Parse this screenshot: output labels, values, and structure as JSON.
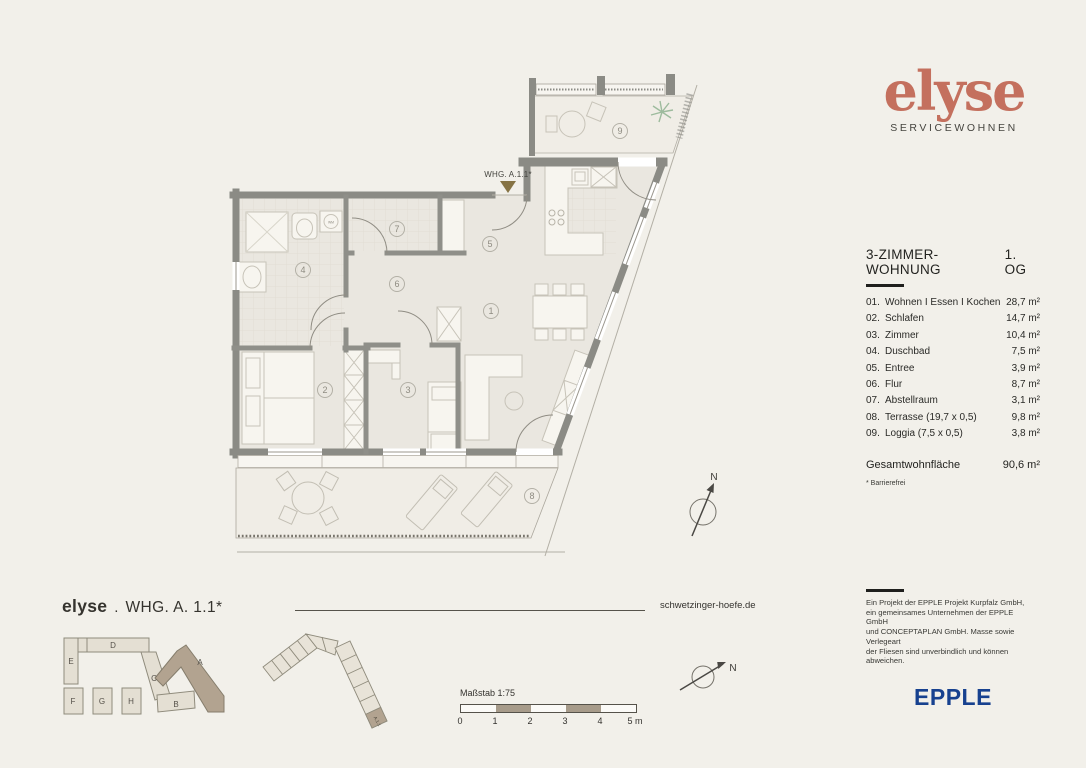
{
  "brand": {
    "logo": "elyse",
    "tagline": "SERVICEWOHNEN",
    "accent_color": "#c4705e"
  },
  "unit": {
    "heading": "3-ZIMMER-WOHNUNG",
    "floor": "1. OG"
  },
  "rooms": [
    {
      "num": "01.",
      "name": "Wohnen I Essen I Kochen",
      "area": "28,7 m²"
    },
    {
      "num": "02.",
      "name": "Schlafen",
      "area": "14,7 m²"
    },
    {
      "num": "03.",
      "name": "Zimmer",
      "area": "10,4 m²"
    },
    {
      "num": "04.",
      "name": "Duschbad",
      "area": "7,5 m²"
    },
    {
      "num": "05.",
      "name": "Entree",
      "area": "3,9 m²"
    },
    {
      "num": "06.",
      "name": "Flur",
      "area": "8,7 m²"
    },
    {
      "num": "07.",
      "name": "Abstellraum",
      "area": "3,1 m²"
    },
    {
      "num": "08.",
      "name": "Terrasse (19,7 x 0,5)",
      "area": "9,8 m²"
    },
    {
      "num": "09.",
      "name": "Loggia (7,5 x 0,5)",
      "area": "3,8 m²"
    }
  ],
  "total": {
    "label": "Gesamtwohnfläche",
    "value": "90,6 m²"
  },
  "footnote": "* Barrierefrei",
  "legal": "Ein Projekt der EPPLE Projekt Kurpfalz GmbH,\nein gemeinsames Unternehmen der EPPLE GmbH\nund CONCEPTAPLAN GmbH. Masse sowie Verlegeart\nder Fliesen sind unverbindlich und können\nabweichen.",
  "publisher": {
    "logo": "EPPLE",
    "color": "#17418f"
  },
  "plan": {
    "marker_label": "WHG. A.1.1*",
    "marker_color": "#867344",
    "wm_label": "WM",
    "compass": "N",
    "room_markers": [
      {
        "n": "1",
        "x": 491,
        "y": 311
      },
      {
        "n": "2",
        "x": 325,
        "y": 390
      },
      {
        "n": "3",
        "x": 408,
        "y": 390
      },
      {
        "n": "4",
        "x": 303,
        "y": 270
      },
      {
        "n": "5",
        "x": 490,
        "y": 244
      },
      {
        "n": "6",
        "x": 397,
        "y": 284
      },
      {
        "n": "7",
        "x": 397,
        "y": 229
      },
      {
        "n": "8",
        "x": 532,
        "y": 496
      },
      {
        "n": "9",
        "x": 620,
        "y": 131
      }
    ]
  },
  "siteplan": {
    "highlight_color": "#b2a390",
    "building_color": "#e4dfd3",
    "unit_label": "A.1.1",
    "labels": [
      {
        "t": "A",
        "x": 200,
        "y": 665
      },
      {
        "t": "B",
        "x": 176,
        "y": 707
      },
      {
        "t": "C",
        "x": 154,
        "y": 681
      },
      {
        "t": "D",
        "x": 113,
        "y": 648
      },
      {
        "t": "E",
        "x": 71,
        "y": 664
      },
      {
        "t": "F",
        "x": 73,
        "y": 704
      },
      {
        "t": "G",
        "x": 102,
        "y": 704
      },
      {
        "t": "H",
        "x": 131,
        "y": 704
      }
    ]
  },
  "footer": {
    "title_brand": "elyse",
    "title_sep": ".",
    "title_unit": "WHG. A. 1.1*",
    "website": "schwetzinger-hoefe.de",
    "scale_label": "Maßstab 1:75",
    "scale_ticks": [
      "0",
      "1",
      "2",
      "3",
      "4",
      "5 m"
    ],
    "scale_tan": "#a79b8a"
  }
}
